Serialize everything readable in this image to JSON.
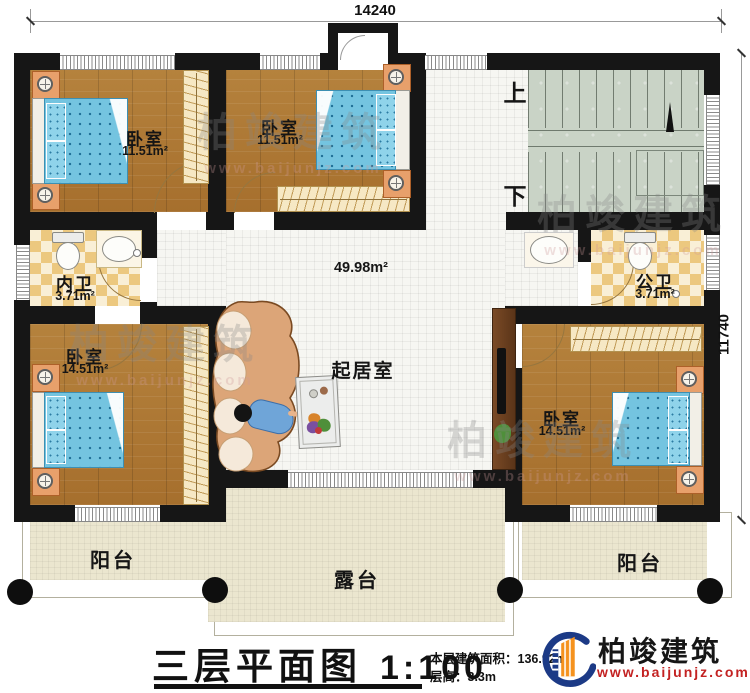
{
  "dimensions": {
    "width_mm": "14240",
    "height_mm": "11740"
  },
  "stairs": {
    "up": "上",
    "down": "下"
  },
  "hall": {
    "area": "49.98m²",
    "living_room": "起居室"
  },
  "rooms": {
    "bedroom_top_left": {
      "name": "卧室",
      "area": "11.51m²"
    },
    "bedroom_top_mid": {
      "name": "卧室",
      "area": "11.51m²"
    },
    "bath_left": {
      "name": "内卫",
      "area": "3.71m²"
    },
    "bath_right": {
      "name": "公卫",
      "area": "3.71m²"
    },
    "bedroom_bottom_left": {
      "name": "卧室",
      "area": "14.51m²"
    },
    "bedroom_bottom_right": {
      "name": "卧室",
      "area": "14.51m²"
    }
  },
  "outdoor": {
    "balcony_left": "阳台",
    "terrace": "露台",
    "balcony_right": "阳台"
  },
  "title_block": {
    "title": "三层平面图",
    "scale": "1:100",
    "area_note": "本层建筑面积：136.92m²",
    "height_note": "层高：3.3m"
  },
  "brand": {
    "name": "柏竣建筑",
    "website": "www.baijunjz.com"
  },
  "watermark": {
    "name": "柏竣建筑",
    "website": "www.baijunjz.com"
  },
  "colors": {
    "wall": "#161616",
    "wood": "#b07b35",
    "checker": "#ecc87f",
    "stairs": "#c9d3c6",
    "bed": "#74c4e0",
    "nightstand": "#e8a06b",
    "brand_red": "#c32222",
    "brand_blue": "#1c3a86"
  }
}
